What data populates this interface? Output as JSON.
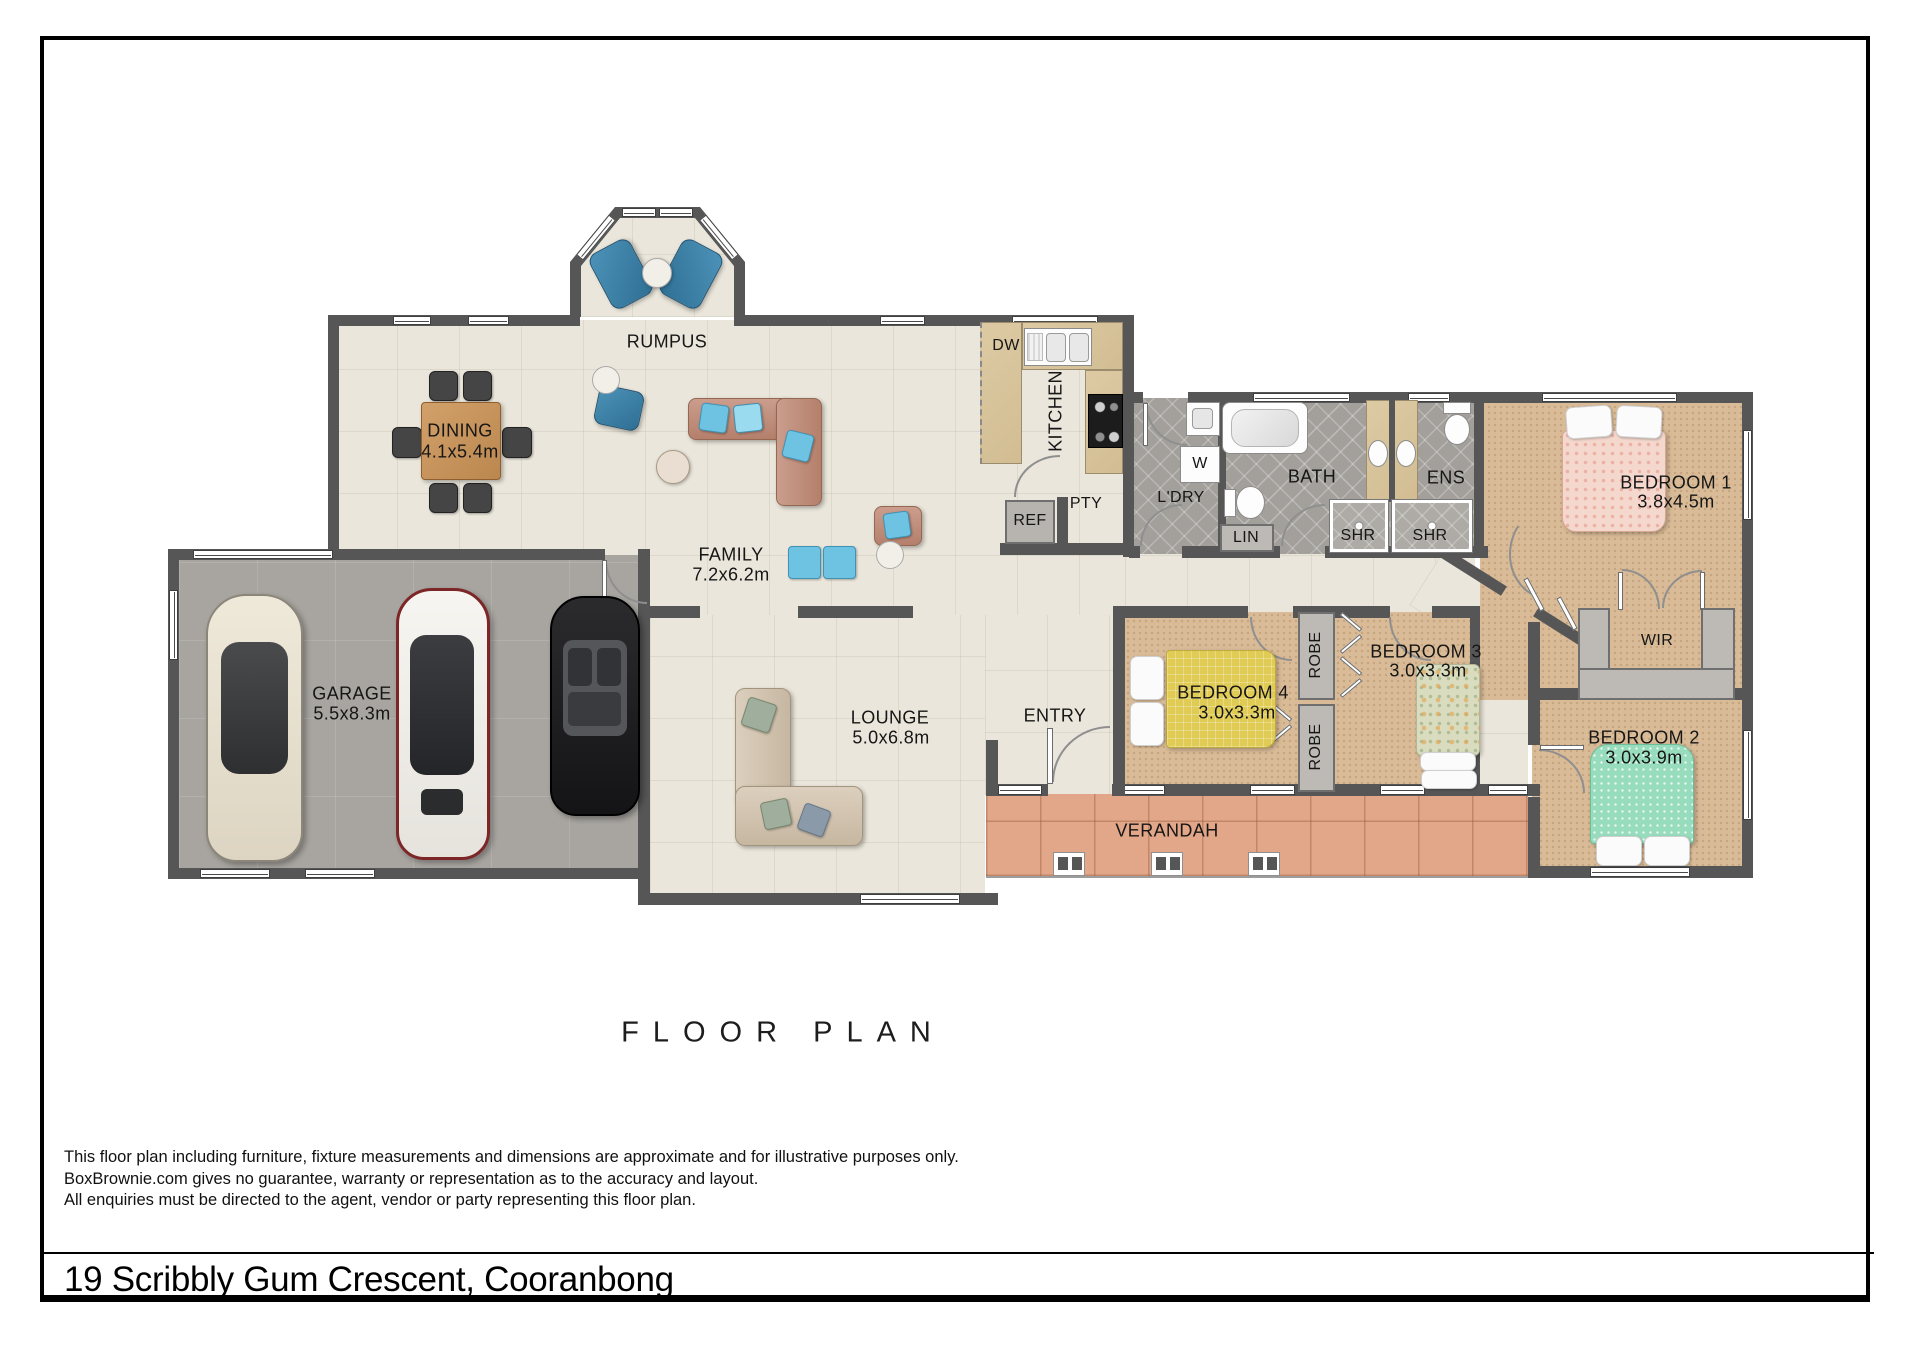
{
  "page": {
    "title": "FLOOR PLAN",
    "address": "19 Scribbly Gum Crescent, Cooranbong",
    "disclaimer": [
      "This floor plan including furniture, fixture measurements and dimensions are approximate and for illustrative purposes only.",
      "BoxBrownie.com gives no guarantee, warranty or representation as to the accuracy and layout.",
      "All enquiries must be directed to the agent, vendor or party representing this floor plan."
    ]
  },
  "rooms": {
    "rumpus": {
      "name": "RUMPUS"
    },
    "dining": {
      "name": "DINING",
      "dims": "4.1x5.4m"
    },
    "family": {
      "name": "FAMILY",
      "dims": "7.2x6.2m"
    },
    "kitchen": {
      "name": "KITCHEN"
    },
    "dw": {
      "name": "DW"
    },
    "pty": {
      "name": "PTY"
    },
    "ref": {
      "name": "REF"
    },
    "ldry": {
      "name": "L'DRY"
    },
    "washer": {
      "name": "W"
    },
    "bath": {
      "name": "BATH"
    },
    "lin": {
      "name": "LIN"
    },
    "shr_bath": {
      "name": "SHR"
    },
    "shr_ens": {
      "name": "SHR"
    },
    "ens": {
      "name": "ENS"
    },
    "bedroom1": {
      "name": "BEDROOM 1",
      "dims": "3.8x4.5m"
    },
    "wir": {
      "name": "WIR"
    },
    "bedroom2": {
      "name": "BEDROOM 2",
      "dims": "3.0x3.9m"
    },
    "bedroom3": {
      "name": "BEDROOM 3",
      "dims": "3.0x3.3m"
    },
    "bedroom4": {
      "name": "BEDROOM 4",
      "dims": "3.0x3.3m"
    },
    "robe_top": {
      "name": "ROBE"
    },
    "robe_bot": {
      "name": "ROBE"
    },
    "garage": {
      "name": "GARAGE",
      "dims": "5.5x8.3m"
    },
    "lounge": {
      "name": "LOUNGE",
      "dims": "5.0x6.8m"
    },
    "entry": {
      "name": "ENTRY"
    },
    "verandah": {
      "name": "VERANDAH"
    }
  },
  "colors": {
    "wall": "#565656",
    "floor_tile": "#eae6db",
    "floor_garage": "#a8a5a0",
    "floor_wet": "#a3a09b",
    "floor_carpet": "#d9bb97",
    "floor_verandah": "#e2a688",
    "kitchen_bench": "#dbc8a1",
    "accent_blue": "#3d7ea8",
    "sofa_salmon": "#c99a8a",
    "bed1_pink": "#f4d7cd",
    "bed2_green": "#97dcbd",
    "bed3_floral": "#dadcc0",
    "bed4_yellow": "#e0cc55"
  }
}
